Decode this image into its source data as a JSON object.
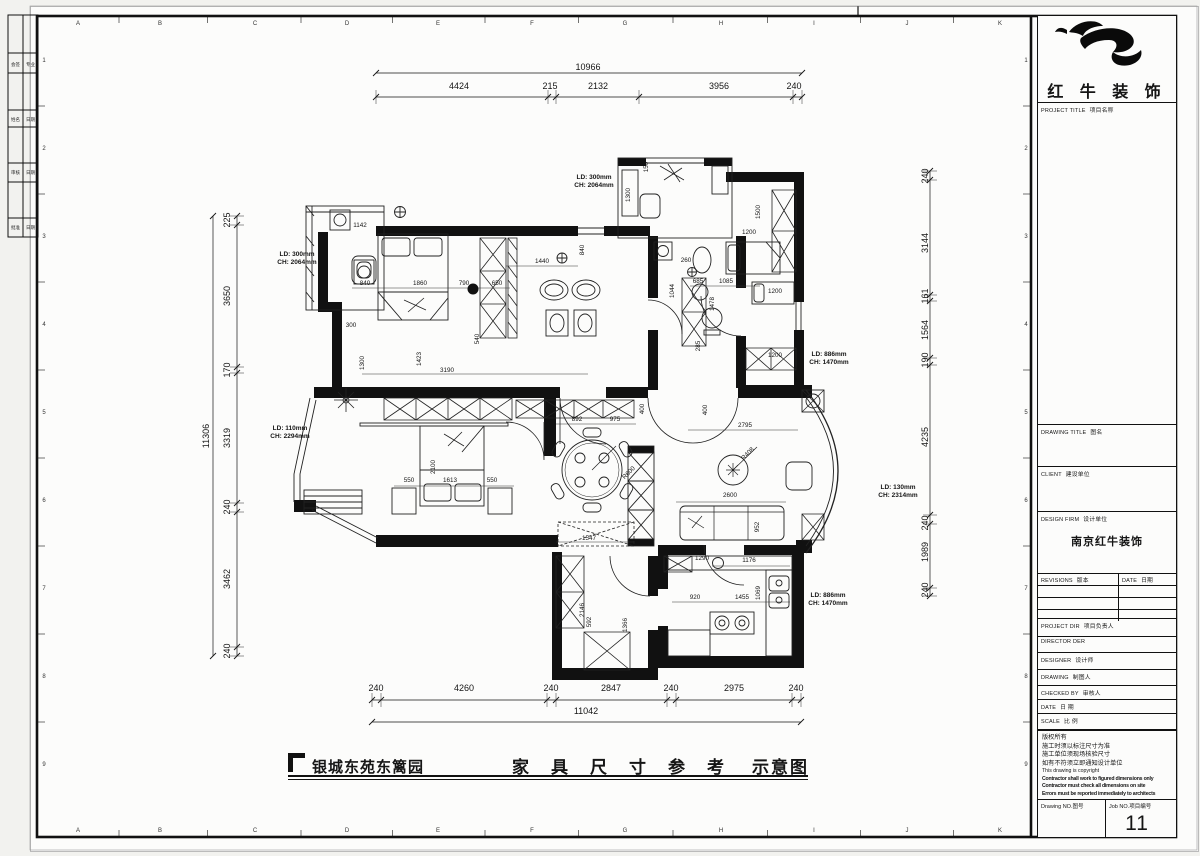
{
  "colors": {
    "ink": "#151515",
    "paper": "#fcfcfb",
    "bg": "#f2f2ef"
  },
  "frame": {
    "grid_letters": [
      "A",
      "B",
      "C",
      "D",
      "E",
      "F",
      "G",
      "H",
      "I",
      "J",
      "K"
    ],
    "letter_x": [
      78,
      160,
      255,
      347,
      438,
      532,
      625,
      721,
      814,
      907,
      1000
    ],
    "row_numbers": [
      "1",
      "2",
      "3",
      "4",
      "5",
      "6",
      "7",
      "8",
      "9"
    ]
  },
  "sign_strip": {
    "rows": [
      [
        "会签",
        "专业"
      ],
      [
        "姓名",
        "日期"
      ],
      [
        "审核",
        "日期"
      ],
      [
        "批准",
        "日期"
      ]
    ]
  },
  "title_block": {
    "brand": "红 牛 装 饰",
    "project_title": {
      "en": "PROJECT TITLE",
      "zh": "项目名称"
    },
    "drawing_title": {
      "en": "DRAWING TITLE",
      "zh": "图名"
    },
    "client": {
      "en": "CLIENT",
      "zh": "建设单位"
    },
    "design_firm": {
      "en": "DESIGN FIRM",
      "zh": "设计单位",
      "value": "南京红牛装饰"
    },
    "revisions": {
      "en": "REVISIONS",
      "zh": "版本"
    },
    "date_col": {
      "en": "DATE",
      "zh": "日期"
    },
    "project_dir": {
      "en": "PROJECT DIR",
      "zh": "项目负责人"
    },
    "director": {
      "en": "DIRECTOR DER",
      "zh": ""
    },
    "designer": {
      "en": "DESIGNER",
      "zh": "设计师"
    },
    "drawing_by": {
      "en": "DRAWING",
      "zh": "制图人"
    },
    "checked_by": {
      "en": "CHECKED BY",
      "zh": "审核人"
    },
    "date": {
      "en": "DATE",
      "zh": "日 期"
    },
    "scale": {
      "en": "SCALE",
      "zh": "比 例"
    },
    "notes": [
      "版权所有",
      "施工时须以标注尺寸为准",
      "施工单位须现场核验尺寸",
      "如有不符须立即通知设计单位",
      "This drawing is copyright",
      "Contractor shall work to figured dimensions only",
      "Contractor must check all dimensions on site",
      "Errors must be reported immediately to architects"
    ],
    "drawing_no": {
      "en": "Drawing NO.",
      "zh": "图号"
    },
    "job_no": {
      "en": "Job NO.",
      "zh": "项目编号",
      "value": "11"
    }
  },
  "footer": {
    "project": "银城东苑东篱园",
    "title_main": "家具尺寸参考",
    "title_suffix": "示意图"
  },
  "plan": {
    "chain_labels": [
      {
        "t": "10966",
        "x": 588,
        "y": 70
      },
      {
        "t": "4424",
        "x": 459,
        "y": 89
      },
      {
        "t": "215",
        "x": 550,
        "y": 89
      },
      {
        "t": "2132",
        "x": 598,
        "y": 89
      },
      {
        "t": "3956",
        "x": 719,
        "y": 89
      },
      {
        "t": "240",
        "x": 794,
        "y": 89
      },
      {
        "t": "240",
        "x": 376,
        "y": 691
      },
      {
        "t": "4260",
        "x": 464,
        "y": 691
      },
      {
        "t": "240",
        "x": 551,
        "y": 691
      },
      {
        "t": "2847",
        "x": 611,
        "y": 691
      },
      {
        "t": "240",
        "x": 671,
        "y": 691
      },
      {
        "t": "2975",
        "x": 734,
        "y": 691
      },
      {
        "t": "240",
        "x": 796,
        "y": 691
      },
      {
        "t": "11042",
        "x": 586,
        "y": 714
      },
      {
        "t": "225",
        "x": 230,
        "y": 220,
        "r": -90
      },
      {
        "t": "3650",
        "x": 230,
        "y": 296,
        "r": -90
      },
      {
        "t": "170",
        "x": 230,
        "y": 370,
        "r": -90
      },
      {
        "t": "3319",
        "x": 230,
        "y": 438,
        "r": -90
      },
      {
        "t": "11306",
        "x": 209,
        "y": 436,
        "r": -90
      },
      {
        "t": "240",
        "x": 230,
        "y": 507,
        "r": -90
      },
      {
        "t": "3462",
        "x": 230,
        "y": 579,
        "r": -90
      },
      {
        "t": "240",
        "x": 230,
        "y": 651,
        "r": -90
      },
      {
        "t": "240",
        "x": 928,
        "y": 176,
        "r": -90
      },
      {
        "t": "3144",
        "x": 928,
        "y": 243,
        "r": -90
      },
      {
        "t": "161",
        "x": 928,
        "y": 296,
        "r": -90
      },
      {
        "t": "1564",
        "x": 928,
        "y": 330,
        "r": -90
      },
      {
        "t": "190",
        "x": 928,
        "y": 360,
        "r": -90
      },
      {
        "t": "4235",
        "x": 928,
        "y": 437,
        "r": -90
      },
      {
        "t": "240",
        "x": 928,
        "y": 523,
        "r": -90
      },
      {
        "t": "1989",
        "x": 928,
        "y": 552,
        "r": -90
      },
      {
        "t": "240",
        "x": 928,
        "y": 590,
        "r": -90
      }
    ],
    "dim_labels": [
      {
        "t": "1142",
        "x": 360,
        "y": 227
      },
      {
        "t": "840",
        "x": 365,
        "y": 285
      },
      {
        "t": "1860",
        "x": 420,
        "y": 285
      },
      {
        "t": "790",
        "x": 464,
        "y": 285
      },
      {
        "t": "650",
        "x": 497,
        "y": 285
      },
      {
        "t": "1440",
        "x": 542,
        "y": 263
      },
      {
        "t": "840",
        "x": 584,
        "y": 250,
        "r": -90
      },
      {
        "t": "540",
        "x": 479,
        "y": 339,
        "r": -90
      },
      {
        "t": "1423",
        "x": 421,
        "y": 359,
        "r": -90
      },
      {
        "t": "3190",
        "x": 447,
        "y": 372
      },
      {
        "t": "300",
        "x": 351,
        "y": 327
      },
      {
        "t": "1300",
        "x": 364,
        "y": 363,
        "r": -90
      },
      {
        "t": "892",
        "x": 577,
        "y": 421
      },
      {
        "t": "975",
        "x": 615,
        "y": 421
      },
      {
        "t": "400",
        "x": 644,
        "y": 409,
        "r": -90
      },
      {
        "t": "150",
        "x": 648,
        "y": 167,
        "r": -90
      },
      {
        "t": "1300",
        "x": 630,
        "y": 195,
        "r": -90
      },
      {
        "t": "260",
        "x": 686,
        "y": 262
      },
      {
        "t": "1044",
        "x": 674,
        "y": 291,
        "r": -90
      },
      {
        "t": "685",
        "x": 698,
        "y": 283
      },
      {
        "t": "1085",
        "x": 726,
        "y": 283
      },
      {
        "t": "1478",
        "x": 714,
        "y": 304,
        "r": -90
      },
      {
        "t": "285",
        "x": 700,
        "y": 346,
        "r": -90
      },
      {
        "t": "1500",
        "x": 760,
        "y": 212,
        "r": -90
      },
      {
        "t": "1200",
        "x": 749,
        "y": 234
      },
      {
        "t": "1200",
        "x": 775,
        "y": 293
      },
      {
        "t": "1200",
        "x": 775,
        "y": 357
      },
      {
        "t": "600",
        "x": 741,
        "y": 382,
        "r": -90
      },
      {
        "t": "2795",
        "x": 745,
        "y": 427
      },
      {
        "t": "400",
        "x": 707,
        "y": 410,
        "r": -90
      },
      {
        "t": "2600",
        "x": 730,
        "y": 497
      },
      {
        "t": "952",
        "x": 759,
        "y": 527,
        "r": -90
      },
      {
        "t": "1176",
        "x": 749,
        "y": 562
      },
      {
        "t": "1290",
        "x": 702,
        "y": 560
      },
      {
        "t": "920",
        "x": 695,
        "y": 599
      },
      {
        "t": "1455",
        "x": 742,
        "y": 599
      },
      {
        "t": "1069",
        "x": 760,
        "y": 593,
        "r": -90
      },
      {
        "t": "550",
        "x": 409,
        "y": 482
      },
      {
        "t": "1613",
        "x": 450,
        "y": 482
      },
      {
        "t": "550",
        "x": 492,
        "y": 482
      },
      {
        "t": "2100",
        "x": 435,
        "y": 467,
        "r": -90
      },
      {
        "t": "1547",
        "x": 589,
        "y": 540
      },
      {
        "t": "2146",
        "x": 584,
        "y": 610,
        "r": -90
      },
      {
        "t": "592",
        "x": 591,
        "y": 622,
        "r": -90
      },
      {
        "t": "1366",
        "x": 627,
        "y": 625,
        "r": -90
      },
      {
        "t": "R600",
        "x": 630,
        "y": 474,
        "r": -45
      },
      {
        "t": "R408",
        "x": 749,
        "y": 455,
        "r": -45
      }
    ],
    "annotations": [
      {
        "t": "LD: 300mm",
        "x": 297,
        "y": 256
      },
      {
        "t": "CH: 2064mm",
        "x": 297,
        "y": 264
      },
      {
        "t": "LD: 300mm",
        "x": 594,
        "y": 179
      },
      {
        "t": "CH: 2064mm",
        "x": 594,
        "y": 187
      },
      {
        "t": "LD: 110mm",
        "x": 290,
        "y": 430
      },
      {
        "t": "CH: 2294mm",
        "x": 290,
        "y": 438
      },
      {
        "t": "LD: 886mm",
        "x": 829,
        "y": 356
      },
      {
        "t": "CH: 1470mm",
        "x": 829,
        "y": 364
      },
      {
        "t": "LD: 130mm",
        "x": 898,
        "y": 489
      },
      {
        "t": "CH: 2314mm",
        "x": 898,
        "y": 497
      },
      {
        "t": "LD: 886mm",
        "x": 828,
        "y": 597
      },
      {
        "t": "CH: 1470mm",
        "x": 828,
        "y": 605
      }
    ],
    "chains": {
      "top": {
        "type": "h",
        "line": 97,
        "total": 73,
        "ticks": [
          376,
          548,
          556,
          639,
          793,
          802
        ]
      },
      "bottom": {
        "type": "h",
        "line": 700,
        "total": 722,
        "ticks": [
          372,
          381,
          547,
          556,
          667,
          676,
          792,
          801
        ]
      },
      "left": {
        "type": "v",
        "line": 237,
        "total": 213,
        "ticks": [
          216,
          225,
          367,
          373,
          503,
          512,
          647,
          656
        ]
      },
      "right": {
        "type": "v",
        "line": 930,
        "total": null,
        "ticks": [
          171,
          180,
          295,
          301,
          358,
          365,
          515,
          524,
          588,
          596
        ]
      }
    }
  }
}
